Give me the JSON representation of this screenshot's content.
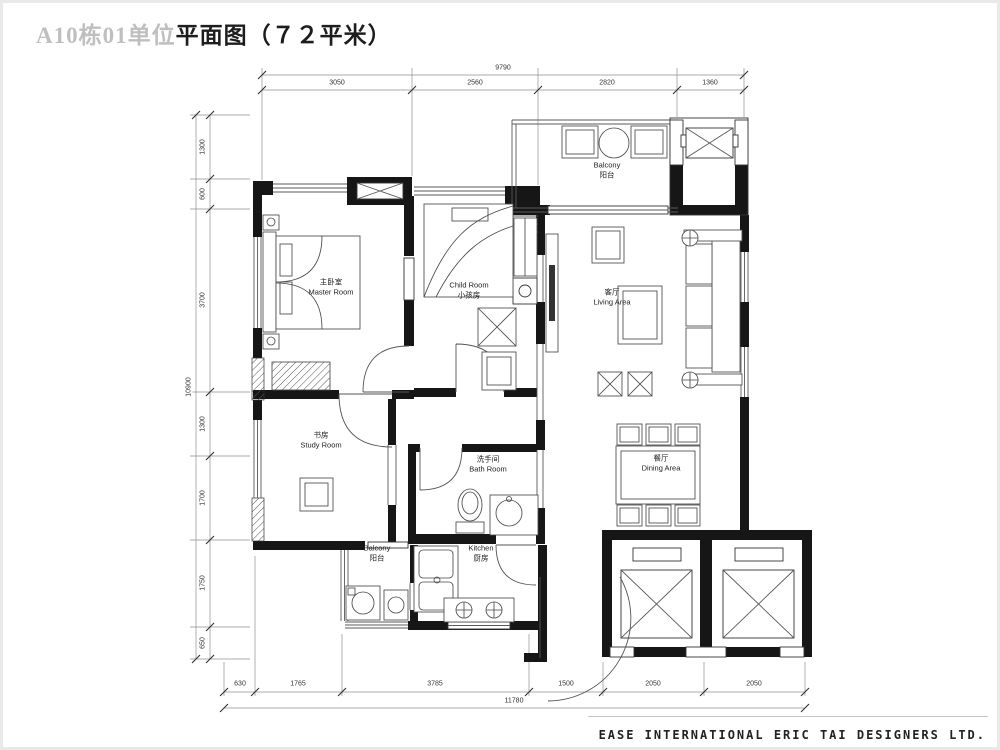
{
  "title": {
    "faint": "A10栋01单位",
    "main": "平面图（７２平米）"
  },
  "footer": {
    "company": "EASE INTERNATIONAL ERIC TAI DESIGNERS LTD."
  },
  "rooms": [
    {
      "id": "master-room",
      "line1": "主卧室",
      "line2": "Master Room",
      "x": 331,
      "y": 287
    },
    {
      "id": "child-room",
      "line1": "Child Room",
      "line2": "小孩房",
      "x": 469,
      "y": 290
    },
    {
      "id": "living-area",
      "line1": "客厅",
      "line2": "Living Area",
      "x": 612,
      "y": 297
    },
    {
      "id": "balcony-top",
      "line1": "Balcony",
      "line2": "阳台",
      "x": 607,
      "y": 170
    },
    {
      "id": "study-room",
      "line1": "书房",
      "line2": "Study Room",
      "x": 321,
      "y": 440
    },
    {
      "id": "bath-room",
      "line1": "洗手间",
      "line2": "Bath Room",
      "x": 488,
      "y": 464
    },
    {
      "id": "dining-area",
      "line1": "餐厅",
      "line2": "Dining Area",
      "x": 661,
      "y": 463
    },
    {
      "id": "balcony-bottom",
      "line1": "Balcony",
      "line2": "阳台",
      "x": 377,
      "y": 553
    },
    {
      "id": "kitchen",
      "line1": "Kitchen",
      "line2": "厨房",
      "x": 481,
      "y": 553
    }
  ],
  "dimensions": {
    "top": {
      "overall": {
        "text": "9790",
        "x": 503,
        "y": 68,
        "rot": 0
      },
      "segments": [
        {
          "text": "3050",
          "x": 337,
          "y": 83,
          "rot": 0
        },
        {
          "text": "2560",
          "x": 475,
          "y": 83,
          "rot": 0
        },
        {
          "text": "2820",
          "x": 607,
          "y": 83,
          "rot": 0
        },
        {
          "text": "1360",
          "x": 710,
          "y": 83,
          "rot": 0
        }
      ]
    },
    "left": {
      "overall": {
        "text": "10900",
        "x": 189,
        "y": 387,
        "rot": -90
      },
      "segments": [
        {
          "text": "1300",
          "x": 203,
          "y": 147,
          "rot": -90
        },
        {
          "text": "600",
          "x": 203,
          "y": 194,
          "rot": -90
        },
        {
          "text": "3700",
          "x": 203,
          "y": 300,
          "rot": -90
        },
        {
          "text": "1300",
          "x": 203,
          "y": 424,
          "rot": -90
        },
        {
          "text": "1700",
          "x": 203,
          "y": 498,
          "rot": -90
        },
        {
          "text": "1750",
          "x": 203,
          "y": 583,
          "rot": -90
        },
        {
          "text": "650",
          "x": 203,
          "y": 643,
          "rot": -90
        }
      ]
    },
    "bottom": {
      "overall": {
        "text": "11780",
        "x": 514,
        "y": 701,
        "rot": 0
      },
      "segments": [
        {
          "text": "630",
          "x": 240,
          "y": 684,
          "rot": 0
        },
        {
          "text": "1765",
          "x": 298,
          "y": 684,
          "rot": 0
        },
        {
          "text": "3785",
          "x": 435,
          "y": 684,
          "rot": 0
        },
        {
          "text": "1500",
          "x": 566,
          "y": 684,
          "rot": 0
        },
        {
          "text": "2050",
          "x": 653,
          "y": 684,
          "rot": 0
        },
        {
          "text": "2050",
          "x": 754,
          "y": 684,
          "rot": 0
        }
      ]
    }
  }
}
